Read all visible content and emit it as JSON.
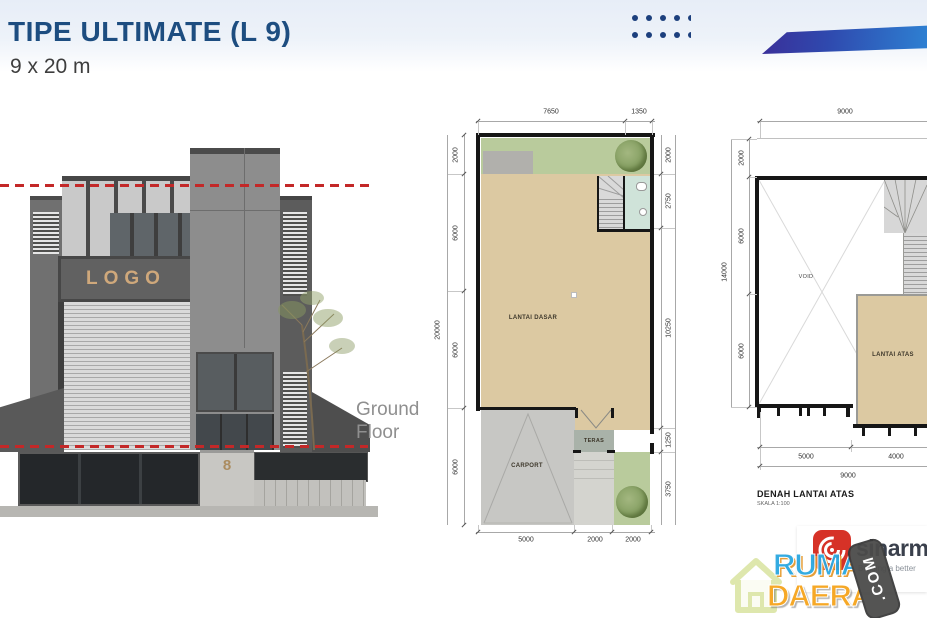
{
  "slide": {
    "title": "TIPE ULTIMATE (L 9)",
    "subtitle": "9 x 20 m"
  },
  "elevation": {
    "logo_text": "LOGO",
    "house_number": "8",
    "floor_label": "Ground Floor"
  },
  "ground_plan": {
    "room_label": "LANTAI DASAR",
    "carport_label": "CARPORT",
    "teras_label": "TERAS",
    "dims": {
      "top": [
        "7650",
        "1350"
      ],
      "left_total": "20000",
      "left": [
        "2000",
        "6000",
        "6000",
        "6000"
      ],
      "right": [
        "2000",
        "2750",
        "10250",
        "1250",
        "3750"
      ],
      "bottom": [
        "5000",
        "2000",
        "2000"
      ]
    }
  },
  "upper_plan": {
    "room_label": "LANTAI ATAS",
    "void_label": "VOID",
    "caption_title": "DENAH LANTAI ATAS",
    "caption_scale": "SKALA 1:100",
    "dims": {
      "top_total": "9000",
      "left_total": "14000",
      "left": [
        "2000",
        "6000",
        "6000"
      ],
      "bottom": [
        "5000",
        "4000"
      ],
      "bottom_total": "9000"
    }
  },
  "branding": {
    "developer_name": "sinarmas",
    "developer_tagline": "Building a better",
    "watermark_top": "RUMAH",
    "watermark_bottom": "DAERAH",
    "watermark_suffix": ".COM"
  },
  "colors": {
    "title_navy": "#1d4d80",
    "dots_navy": "#1c3f7d",
    "banner_start": "#3a2f99",
    "banner_end": "#2e80d2",
    "red_level_line": "#c32828",
    "floor_tan": "#dcc9a2",
    "garden_green": "#b9cb9c",
    "bath_green": "#cfe3d9",
    "sinarmas_red": "#d63227",
    "watermark_blue": "#2aa7e0",
    "watermark_orange": "#f6a41c"
  }
}
